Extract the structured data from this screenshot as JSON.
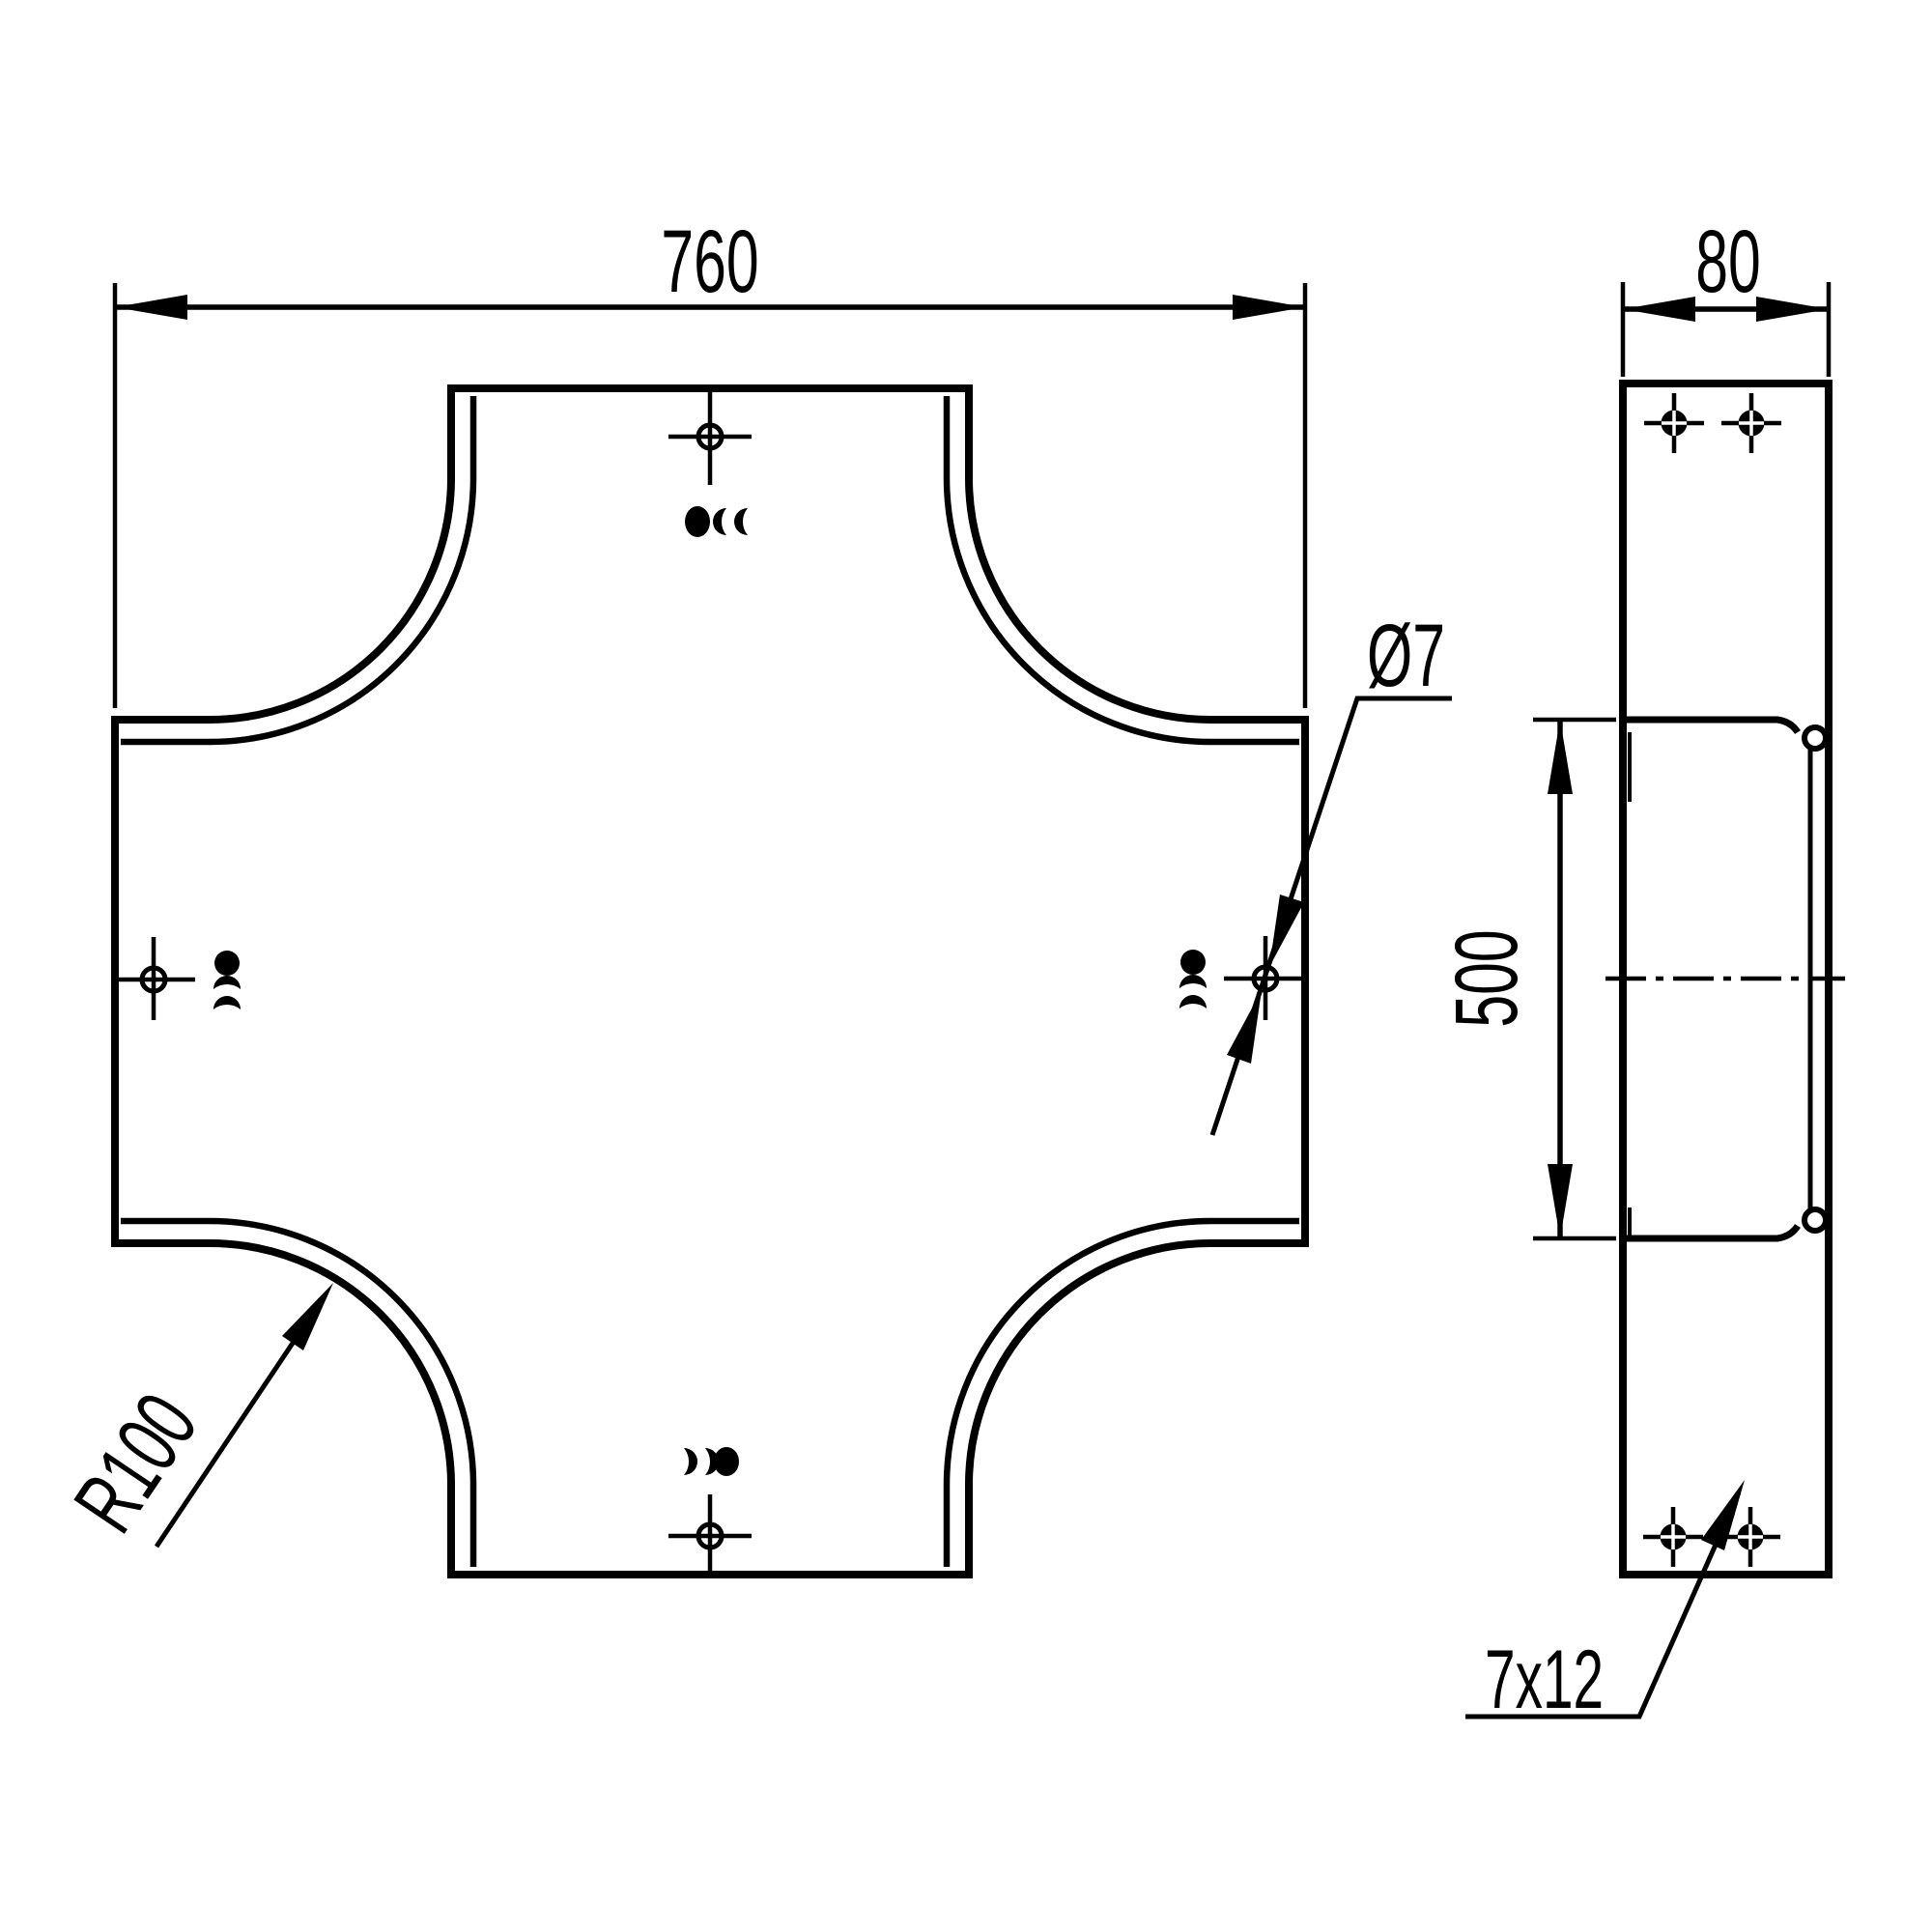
{
  "drawing": {
    "title": "cross-cover technical drawing",
    "front_view": {
      "overall_width": "760",
      "corner_radius": "R100",
      "hole_diameter": "Ø7"
    },
    "side_view": {
      "depth": "80",
      "opening_length": "500",
      "slot_size": "7x12"
    }
  }
}
